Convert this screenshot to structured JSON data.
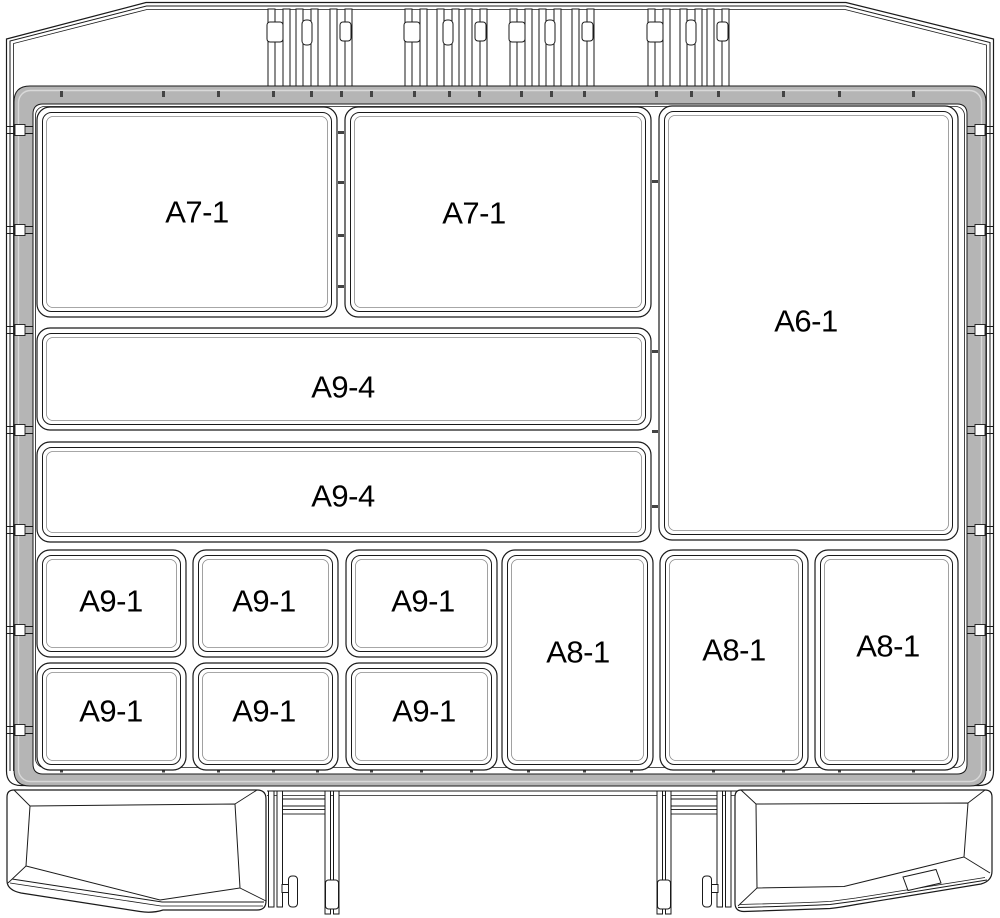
{
  "diagram": {
    "compartments": [
      {
        "label": "A7-1",
        "x": 37,
        "y": 107,
        "w": 300,
        "h": 210,
        "lx": 197,
        "ly": 212
      },
      {
        "label": "A7-1",
        "x": 345,
        "y": 107,
        "w": 306,
        "h": 210,
        "lx": 474,
        "ly": 213
      },
      {
        "label": "A6-1",
        "x": 659,
        "y": 106,
        "w": 299,
        "h": 434,
        "lx": 806,
        "ly": 321
      },
      {
        "label": "A9-4",
        "x": 37,
        "y": 328,
        "w": 614,
        "h": 102,
        "lx": 343,
        "ly": 387
      },
      {
        "label": "A9-4",
        "x": 37,
        "y": 442,
        "w": 614,
        "h": 100,
        "lx": 343,
        "ly": 496
      },
      {
        "label": "A9-1",
        "x": 37,
        "y": 550,
        "w": 149,
        "h": 107,
        "lx": 111,
        "ly": 601
      },
      {
        "label": "A9-1",
        "x": 193,
        "y": 550,
        "w": 145,
        "h": 107,
        "lx": 264,
        "ly": 601
      },
      {
        "label": "A9-1",
        "x": 346,
        "y": 550,
        "w": 151,
        "h": 107,
        "lx": 423,
        "ly": 601
      },
      {
        "label": "A8-1",
        "x": 502,
        "y": 550,
        "w": 151,
        "h": 220,
        "lx": 578,
        "ly": 652
      },
      {
        "label": "A8-1",
        "x": 660,
        "y": 550,
        "w": 148,
        "h": 220,
        "lx": 734,
        "ly": 650
      },
      {
        "label": "A8-1",
        "x": 815,
        "y": 550,
        "w": 143,
        "h": 220,
        "lx": 888,
        "ly": 646
      },
      {
        "label": "A9-1",
        "x": 37,
        "y": 663,
        "w": 149,
        "h": 107,
        "lx": 111,
        "ly": 711
      },
      {
        "label": "A9-1",
        "x": 193,
        "y": 663,
        "w": 145,
        "h": 107,
        "lx": 264,
        "ly": 711
      },
      {
        "label": "A9-1",
        "x": 346,
        "y": 663,
        "w": 151,
        "h": 107,
        "lx": 424,
        "ly": 711
      }
    ],
    "colors": {
      "line": "#1a1a1a",
      "rim_fill": "#b5b5b5",
      "rim_highlight": "#d9d9d9",
      "light_line": "#8a8a8a",
      "tick": "#444444",
      "background": "#ffffff",
      "label": "#000000"
    },
    "label_font_size": 31
  }
}
